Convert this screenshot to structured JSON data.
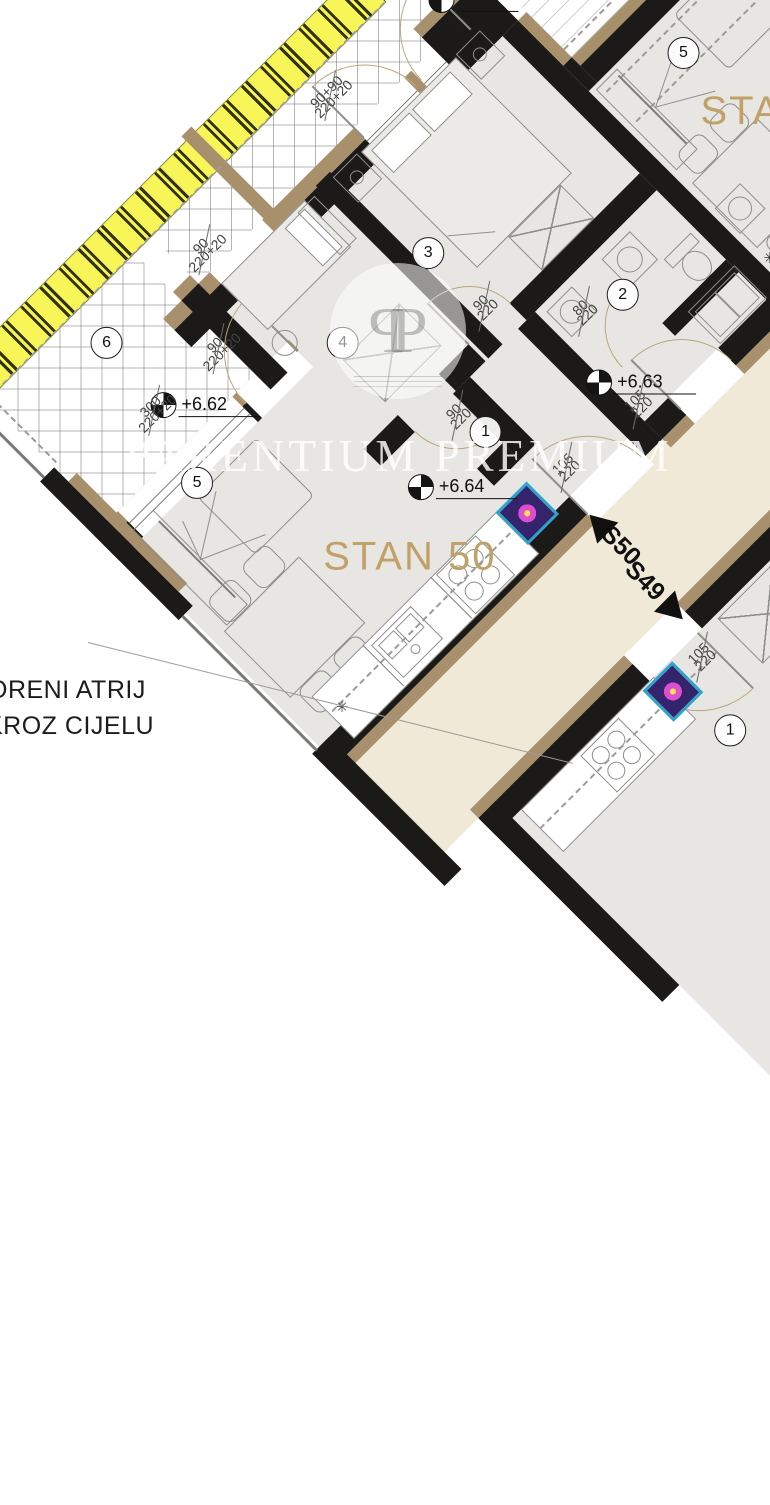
{
  "watermark": {
    "brand": "PARENTIUM PREMIUM",
    "monogram_letter": "P"
  },
  "labels": {
    "apartment_main": "STAN 50",
    "apartment_right_partial": "STAN",
    "unit_s50": "S50",
    "unit_s49": "S49"
  },
  "annotation": {
    "line1": "ORENI ATRIJ",
    "line2": "KROZ CIJELU"
  },
  "elevations": {
    "terrace": "+6.62",
    "right_hall": "+6.63",
    "main_hall": "+6.64"
  },
  "room_numbers": {
    "terrace": "6",
    "living_main": "5",
    "bedroom_a": "3",
    "bedroom_b": "4",
    "bathroom": "2",
    "hall_main": "1",
    "living_right": "5",
    "hall_s49": "1"
  },
  "dimensions": {
    "bed_a_window": {
      "num": "90+90",
      "den": "220+20"
    },
    "bed_b_window": {
      "num": "90",
      "den": "220+20"
    },
    "living_window": {
      "num": "300",
      "den": "220+20"
    },
    "living_door": {
      "num": "90",
      "den": "220+20"
    },
    "bed_a_door": {
      "num": "90",
      "den": "220"
    },
    "bed_b_door": {
      "num": "90",
      "den": "220"
    },
    "bath_door": {
      "num": "80",
      "den": "220"
    },
    "s50_door": {
      "num": "105",
      "den": "220"
    },
    "right_door": {
      "num": "105",
      "den": "220"
    },
    "s49_door": {
      "num": "105",
      "den": "220"
    }
  },
  "symbols": {
    "kitchen_star": "✳"
  },
  "colors": {
    "insulation_yellow": "#f7f557",
    "wall_dark": "#1b1a18",
    "wall_brown": "#a9906c",
    "floor_room": "#e7e6e3",
    "floor_corridor": "#f1e9d7",
    "accent_tan": "#c2a169",
    "boiler_cyan": "#2fa3cb",
    "boiler_magenta": "#dd4fd2"
  }
}
